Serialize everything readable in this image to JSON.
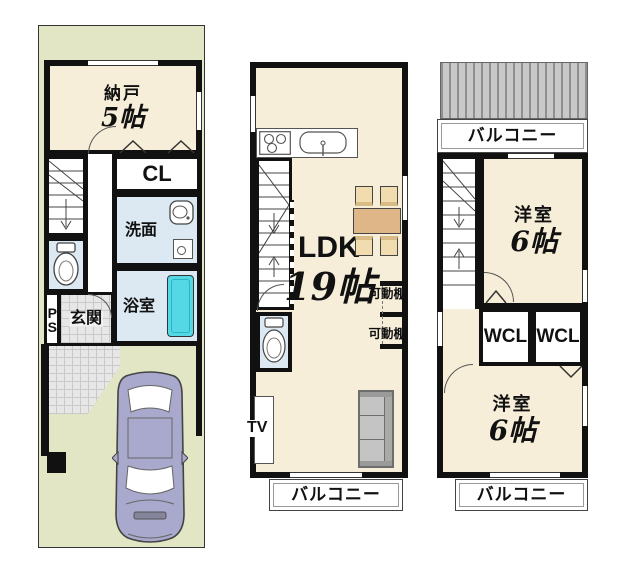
{
  "title": "3-story house floor plan",
  "colors": {
    "site_bg": "#e2e6c4",
    "room_bg": "#f7eed9",
    "wet_area_bg": "#dce9f2",
    "bathtub": "#55d8e6",
    "wall": "#111111",
    "tile": "#e7e7e7",
    "roof_stripe": "#8f8f8f",
    "car_body": "#a9a9cd",
    "table": "#deb688",
    "chair": "#f0dcae",
    "sofa": "#c4c4c4"
  },
  "floor1": {
    "nando_label": "納戸",
    "nando_size": "5帖",
    "cl_label": "CL",
    "senmen_label": "洗面",
    "yokushitsu_label": "浴室",
    "genkan_label": "玄関",
    "ps_label": "PS"
  },
  "floor2": {
    "ldk_label": "LDK",
    "ldk_size": "19帖",
    "shelf1_label": "可動棚",
    "shelf2_label": "可動棚",
    "tv_label": "TV",
    "balcony_label": "バルコニー"
  },
  "floor3": {
    "balcony_top_label": "バルコニー",
    "room_top_label": "洋室",
    "room_top_size": "6帖",
    "wcl1_label": "WCL",
    "wcl2_label": "WCL",
    "room_bottom_label": "洋室",
    "room_bottom_size": "6帖",
    "balcony_bottom_label": "バルコニー"
  }
}
